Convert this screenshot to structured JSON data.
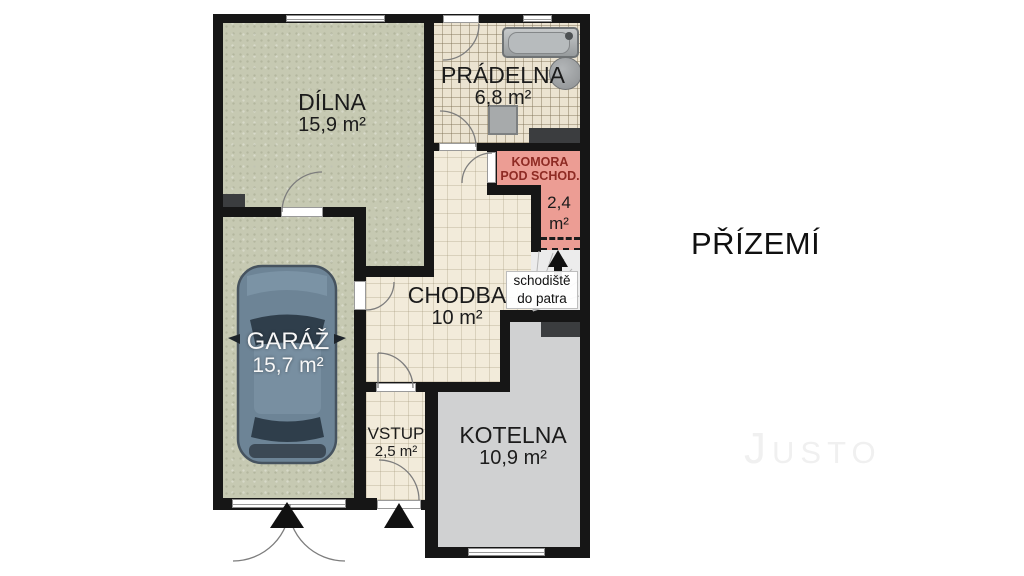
{
  "title": "PŘÍZEMÍ",
  "watermark": "Justo",
  "rooms": {
    "dilna": {
      "name": "DÍLNA",
      "area": "15,9 m²"
    },
    "pradelna": {
      "name": "PRÁDELNA",
      "area": "6,8 m²"
    },
    "komora": {
      "name_line1": "KOMORA",
      "name_line2": "POD SCHOD.",
      "area_line1": "2,4",
      "area_line2": "m²"
    },
    "chodba": {
      "name": "CHODBA",
      "area": "10 m²"
    },
    "garaz": {
      "name": "GARÁŽ",
      "area": "15,7 m²"
    },
    "vstup": {
      "name": "VSTUP",
      "area": "2,5 m²"
    },
    "kotelna": {
      "name": "KOTELNA",
      "area": "10,9 m²"
    },
    "schodiste": {
      "label_line1": "schodiště",
      "label_line2": "do patra"
    }
  },
  "icons": [
    "entrance-arrow-icon",
    "up-arrow-icon",
    "bathtub",
    "water-heater",
    "washing-machine",
    "car"
  ],
  "colors": {
    "wall": "#161616",
    "green": "#c6c9b2",
    "tileBeige": "#ebe3d1",
    "cream": "#f2ebda",
    "pink": "#ec9d94",
    "grayFloor": "#d0d1d2",
    "stairsFloor": "#ececec",
    "darkBlock": "#3b3d3f",
    "label": "#1b1b1b",
    "komoraLabel": "#8e2b24",
    "whiteText": "#f7f7f7",
    "watermark": "#f0f0f0",
    "carBody": "#6d8496",
    "carGlass": "#2f3e4b"
  }
}
